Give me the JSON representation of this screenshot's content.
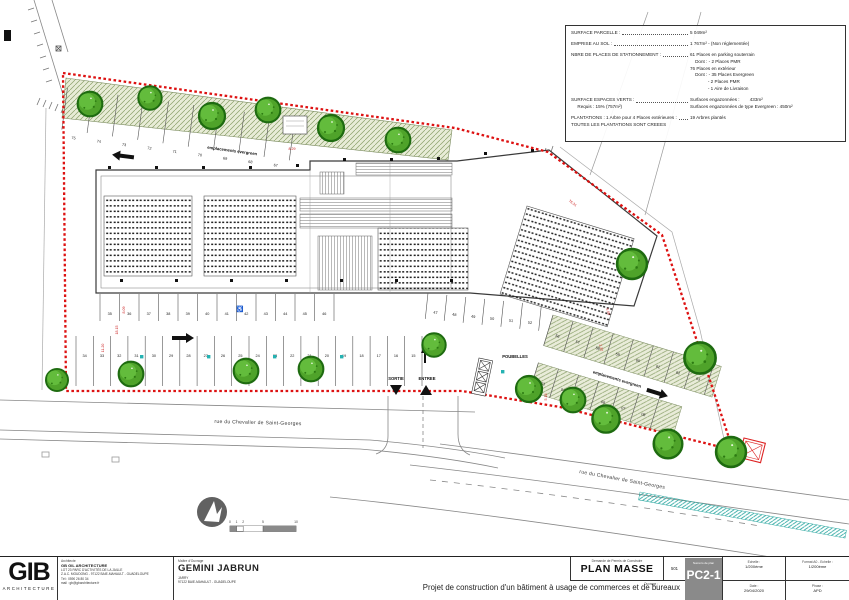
{
  "info_box": {
    "lines": [
      {
        "left": "SURFACE PARCELLE :",
        "dots": true,
        "right": "5 049m²",
        "gap": false
      },
      {
        "left": "EMPRISE AU SOL :",
        "dots": true,
        "right": "1 767m² - (Non réglementée)",
        "gap": true
      },
      {
        "left": "NBRE DE PLACES DE STATIONNEMENT :",
        "dots": true,
        "right": "61 Places en parking souterrain",
        "gap": true
      },
      {
        "left": "",
        "dots": false,
        "right": "    Dont : - 2 Places PMR",
        "gap": false
      },
      {
        "left": "",
        "dots": false,
        "right": "76 Places en extérieur",
        "gap": false
      },
      {
        "left": "",
        "dots": false,
        "right": "    Dont : - 35 Places Evergreen",
        "gap": false
      },
      {
        "left": "",
        "dots": false,
        "right": "              - 2 Places PMR",
        "gap": false
      },
      {
        "left": "",
        "dots": false,
        "right": "              - 1 Aire de Livraison",
        "gap": false
      },
      {
        "left": "SURFACE ESPACES VERTS :",
        "dots": true,
        "right": "Surfaces engazonnées :        433m²",
        "gap": true
      },
      {
        "left": "     Requis : 15% (757m²)",
        "dots": false,
        "right": "Surfaces engazonnées de type Evergreen : 450m²",
        "gap": false
      },
      {
        "left": "PLANTATIONS : 1 Arbre pour 4 Places extérieures :",
        "dots": true,
        "right": "19 Arbres plantés",
        "gap": true
      },
      {
        "left": "TOUTES LES PLANTATIONS SONT CREEES",
        "dots": false,
        "right": "",
        "gap": false
      }
    ]
  },
  "plan": {
    "labels": {
      "evergreen_top": "emplacements evergreen",
      "evergreen_right": "emplacements evergreen",
      "sortie": "SORTIE",
      "entree": "ENTREE",
      "poubelles": "POUBELLES",
      "street_h": "rue du Chevalier de Saint-Georges",
      "street_d": "rue du Chevalier de Saint-Georges"
    },
    "parking": {
      "top_row": [
        "75",
        "74",
        "73",
        "72",
        "71",
        "70",
        "69",
        "68",
        "67"
      ],
      "mid_row": [
        "35",
        "36",
        "37",
        "38",
        "39",
        "40",
        "41",
        "42",
        "43",
        "44",
        "45",
        "46"
      ],
      "mid_row2": [
        "47",
        "48",
        "49",
        "50",
        "51",
        "52"
      ],
      "low_row": [
        "34",
        "33",
        "32",
        "31",
        "30",
        "29",
        "28",
        "27",
        "26",
        "25",
        "24",
        "23",
        "22",
        "21",
        "20",
        "19",
        "18",
        "17",
        "16",
        "15"
      ],
      "right_row": [
        "56",
        "57",
        "58",
        "59",
        "60",
        "61",
        "62",
        "63"
      ],
      "right_row2": [
        "03",
        "04",
        "05",
        "06",
        "07",
        "08"
      ]
    },
    "dimensions": [
      "11.20",
      "18.15",
      "8.09",
      "5.00",
      "2.32",
      "5.16",
      "76.31",
      "8.29"
    ],
    "scale_ticks": [
      "0",
      "1",
      "2",
      "5",
      "10"
    ]
  },
  "colors": {
    "boundary_red": "#dd1111",
    "tree_green": "#4fa32a",
    "evergreen_bg": "#e8ecd7",
    "teal": "#25b2b2",
    "plan_number_bg": "#8a8a8a"
  },
  "title_block": {
    "logo": {
      "text": "GIB",
      "sub": "ARCHITECTURE"
    },
    "architect": {
      "role": "Architecte",
      "name": "GB GIL ARCHITECTURE",
      "lines": [
        "LOT 23 PARC D'ACTIVITÉS DE LA JAILLE",
        "Z.A.C. MOUDONG - 97122 BAIE-MAHAULT - GUADELOUPE",
        "Tél : 0590 26 80 34",
        "mail : gb@gbarchitecture.fr"
      ]
    },
    "owner": {
      "role": "Maître d'Ouvrage",
      "name": "GEMINI JABRUN",
      "lines": [
        "JARRY",
        "97122 BAIE-MAHAULT - GUADELOUPE"
      ]
    },
    "drawing": {
      "header": "Demande de Permis de Construire",
      "title": "PLAN MASSE",
      "index": "501",
      "number_label": "Numéro de plan",
      "number": "PC2-1"
    },
    "meta": {
      "scale_label": "Echelle :",
      "scale": "1/200ème",
      "date_label": "Date :",
      "date": "29/04/2020",
      "format_label": "Format A0 - Echelle :",
      "format": "1/200ème",
      "phase_label": "Phase :",
      "phase": "APD"
    },
    "project": {
      "label": "Ouvrage :",
      "description": "Projet de construction d'un bâtiment à usage de commerces et de bureaux"
    }
  }
}
